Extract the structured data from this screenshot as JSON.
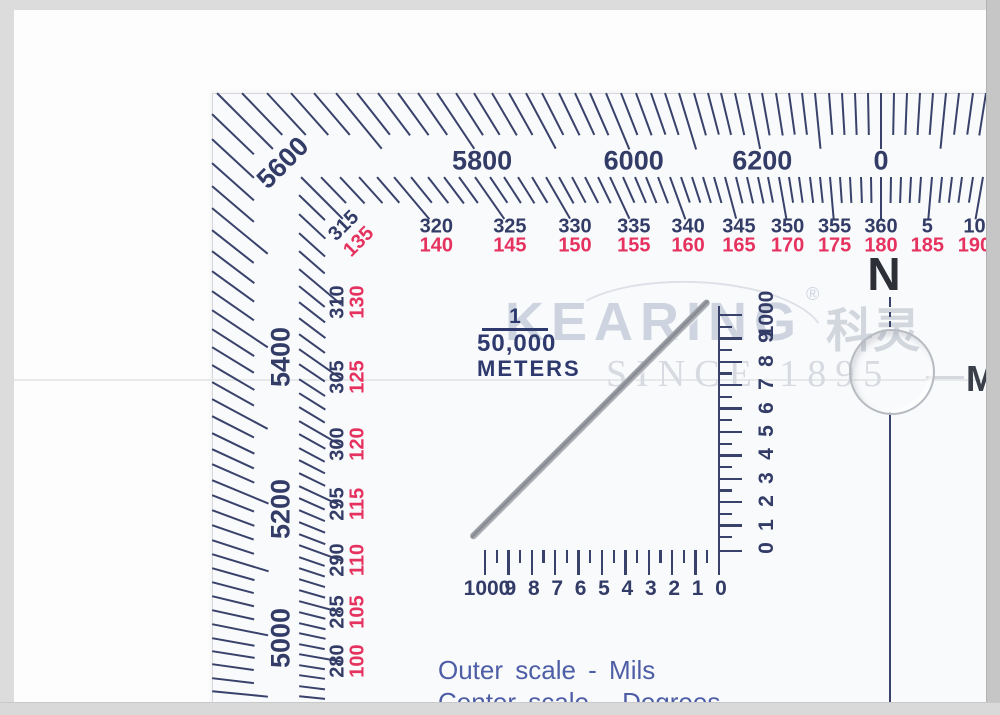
{
  "colors": {
    "marking_navy": "#39426b",
    "degree_red": "#e6325f",
    "caption_blue": "#4e5ea6",
    "watermark_gray": "#cdd4e0"
  },
  "protractor": {
    "outer_scale_mils": {
      "top_labels": [
        {
          "value": 5800,
          "text": "5800"
        },
        {
          "value": 6000,
          "text": "6000"
        },
        {
          "value": 6200,
          "text": "6200"
        },
        {
          "value": 6400,
          "text": "0"
        }
      ],
      "corner_label": {
        "value": 5600,
        "text": "5600"
      },
      "left_labels": [
        {
          "value": 5400,
          "text": "5400"
        },
        {
          "value": 5200,
          "text": "5200"
        },
        {
          "value": 5000,
          "text": "5000"
        }
      ],
      "tick_step_mils": 20,
      "major_step_mils": 100
    },
    "center_scale_degrees": {
      "top_labels": [
        {
          "deg": 320,
          "blue": "320",
          "red": "140"
        },
        {
          "deg": 325,
          "blue": "325",
          "red": "145"
        },
        {
          "deg": 330,
          "blue": "330",
          "red": "150"
        },
        {
          "deg": 335,
          "blue": "335",
          "red": "155"
        },
        {
          "deg": 340,
          "blue": "340",
          "red": "160"
        },
        {
          "deg": 345,
          "blue": "345",
          "red": "165"
        },
        {
          "deg": 350,
          "blue": "350",
          "red": "170"
        },
        {
          "deg": 355,
          "blue": "355",
          "red": "175"
        },
        {
          "deg": 360,
          "blue": "360",
          "red": "180"
        },
        {
          "deg": 5,
          "blue": "5",
          "red": "185"
        },
        {
          "deg": 10,
          "blue": "10",
          "red": "190"
        }
      ],
      "corner_label": {
        "deg": 315,
        "blue": "315",
        "red": "135"
      },
      "left_labels": [
        {
          "deg": 310,
          "blue": "310",
          "red": "130"
        },
        {
          "deg": 305,
          "blue": "305",
          "red": "125"
        },
        {
          "deg": 300,
          "blue": "300",
          "red": "120"
        },
        {
          "deg": 295,
          "blue": "295",
          "red": "115"
        },
        {
          "deg": 290,
          "blue": "290",
          "red": "110"
        },
        {
          "deg": 285,
          "blue": "285",
          "red": "105"
        },
        {
          "deg": 280,
          "blue": "280",
          "red": "100"
        }
      ],
      "tick_step_deg": 1,
      "major_step_deg": 5
    },
    "north_indicator": "N",
    "coordinate_scale": {
      "fraction_numerator": "1",
      "fraction_denominator": "50,000",
      "unit": "METERS",
      "horizontal_numbers": [
        "1000",
        "9",
        "8",
        "7",
        "6",
        "5",
        "4",
        "3",
        "2",
        "1",
        "0"
      ],
      "vertical_numbers": [
        "0",
        "1",
        "2",
        "3",
        "4",
        "5",
        "6",
        "7",
        "8",
        "9",
        "1000"
      ]
    },
    "captions": {
      "line1": "Outer scale - Mils",
      "line2": "Center scale - Degrees"
    },
    "right_edge_partial_letter": "M"
  },
  "watermark": {
    "brand": "KEARING",
    "registered": "®",
    "chinese": "科灵",
    "tagline": "SINCE 1895"
  }
}
